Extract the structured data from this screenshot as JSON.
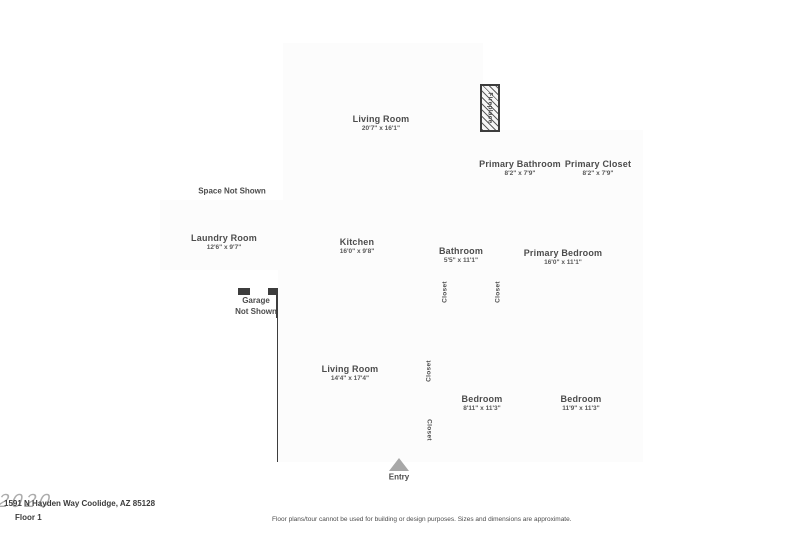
{
  "rooms": [
    {
      "name": "Living Room",
      "dims": "20'7\" x 16'1\""
    },
    {
      "name": "Primary Bathroom",
      "dims": "8'2\" x 7'9\""
    },
    {
      "name": "Primary Closet",
      "dims": "8'2\" x 7'9\""
    },
    {
      "name": "Laundry Room",
      "dims": "12'6\" x 9'7\""
    },
    {
      "name": "Kitchen",
      "dims": "16'0\" x 9'8\""
    },
    {
      "name": "Bathroom",
      "dims": "5'5\" x 11'1\""
    },
    {
      "name": "Primary Bedroom",
      "dims": "16'0\" x 11'1\""
    },
    {
      "name": "Living Room",
      "dims": "14'4\" x 17'4\""
    },
    {
      "name": "Bedroom",
      "dims": "8'11\" x 11'3\""
    },
    {
      "name": "Bedroom",
      "dims": "11'9\" x 11'3\""
    }
  ],
  "annotations": {
    "space_not_shown": "Space Not Shown",
    "garage_line1": "Garage",
    "garage_line2": "Not Shown",
    "entry": "Entry",
    "fireplace": "Fireplace",
    "closet": "Closet"
  },
  "footer": {
    "address": "1591 N Hayden Way Coolidge, AZ 85128",
    "floor_label": "Floor 1",
    "disclaimer": "Floor plans/tour cannot be used for building or design purposes. Sizes and dimensions are approximate.",
    "watermark": "2020"
  },
  "colors": {
    "wall": "#3d3d3d",
    "floor": "#fcfcfc",
    "window": "#ececec",
    "text": "#4c4c4c"
  }
}
